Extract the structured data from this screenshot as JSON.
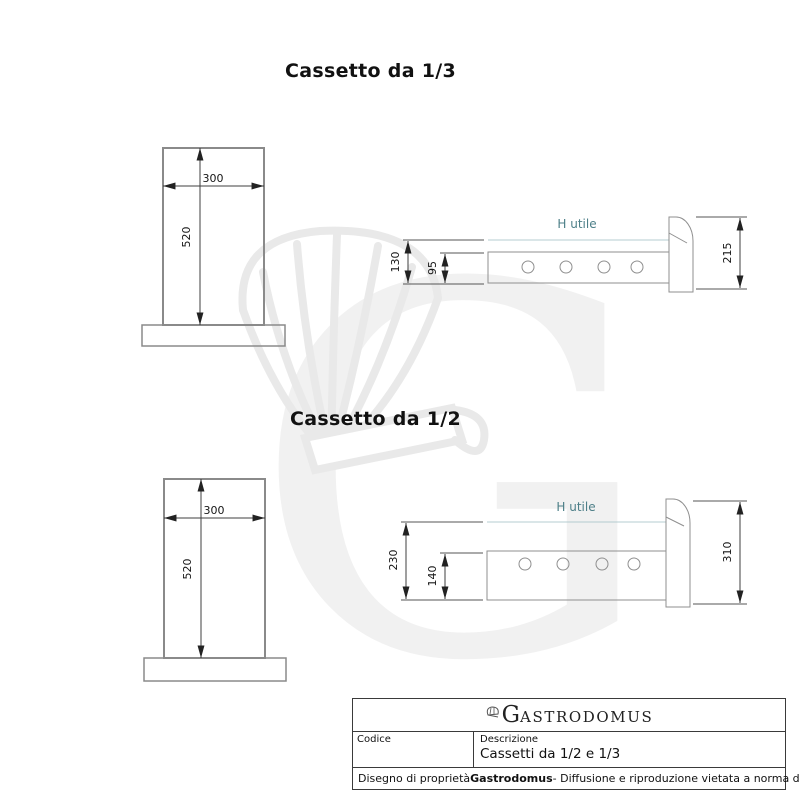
{
  "watermark": {
    "letter": "G"
  },
  "colors": {
    "outline_gray": "#8a8a8a",
    "dimension_dark": "#3f3f3f",
    "teal_text": "#4d7f88",
    "teal_line": "#b4ccd0",
    "watermark_gray": "#f1f1f1"
  },
  "cassetto_13": {
    "title": "Cassetto da 1/3",
    "front": {
      "width": "300",
      "height": "520"
    },
    "side": {
      "h_utile": "H utile",
      "height_total": "130",
      "height_inner": "95",
      "front_height": "215"
    }
  },
  "cassetto_12": {
    "title": "Cassetto da 1/2",
    "front": {
      "width": "300",
      "height": "520"
    },
    "side": {
      "h_utile": "H utile",
      "height_total": "230",
      "height_inner": "140",
      "front_height": "310"
    }
  },
  "title_block": {
    "brand_g": "G",
    "brand_rest": "ASTRODOMUS",
    "codice_label": "Codice",
    "descrizione_label": "Descrizione",
    "descrizione_value": "Cassetti da 1/2 e 1/3",
    "footer_prefix": "Disegno di proprietà ",
    "footer_brand": "Gastrodomus",
    "footer_suffix": " - Diffusione e riproduzione vietata a norma di legge."
  }
}
